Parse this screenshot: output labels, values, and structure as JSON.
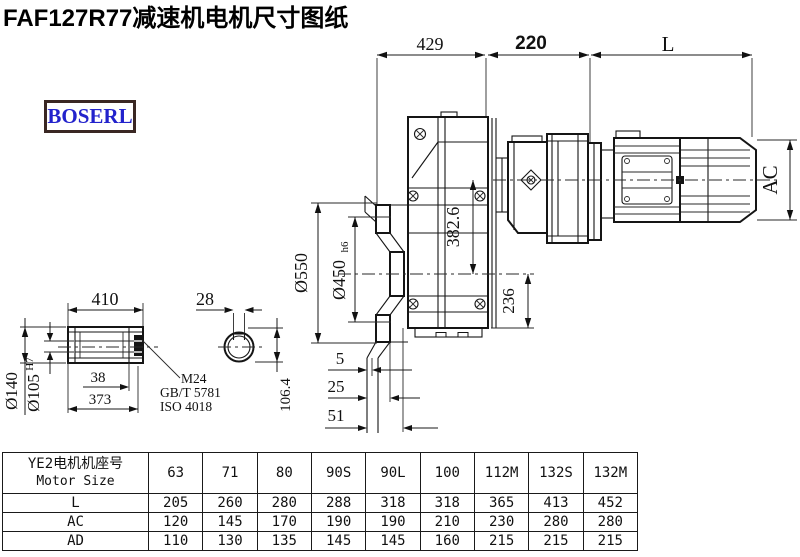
{
  "page": {
    "title": "FAF127R77减速机电机尺寸图纸",
    "logo_text": "BOSERL"
  },
  "dims": {
    "top_429": "429",
    "top_220": "220",
    "top_L": "L",
    "ac": "AC",
    "d550": "Ø550",
    "d450": "Ø450",
    "d450_suffix": "h6",
    "v382": "382.6",
    "v236": "236",
    "s5": "5",
    "s25": "25",
    "s51": "51",
    "shaft_410": "410",
    "shaft_28": "28",
    "d140": "Ø140",
    "d105": "Ø105",
    "d105_sup": "H7",
    "shaft_38": "38",
    "shaft_373": "373",
    "shaft_106": "106.4",
    "note_m24": "M24",
    "note_gb": "GB/T 5781",
    "note_iso": "ISO 4018"
  },
  "table": {
    "header": {
      "title_cn": "YE2电机机座号",
      "title_en": "Motor Size",
      "sizes": [
        "63",
        "71",
        "80",
        "90S",
        "90L",
        "100",
        "112M",
        "132S",
        "132M"
      ]
    },
    "rows": [
      {
        "label": "L",
        "values": [
          "205",
          "260",
          "280",
          "288",
          "318",
          "318",
          "365",
          "413",
          "452"
        ]
      },
      {
        "label": "AC",
        "values": [
          "120",
          "145",
          "170",
          "190",
          "190",
          "210",
          "230",
          "280",
          "280"
        ]
      },
      {
        "label": "AD",
        "values": [
          "110",
          "130",
          "135",
          "145",
          "145",
          "160",
          "215",
          "215",
          "215"
        ]
      }
    ]
  },
  "colors": {
    "line": "#151515",
    "logo_text": "#2222cc",
    "logo_border": "#3a2723"
  }
}
